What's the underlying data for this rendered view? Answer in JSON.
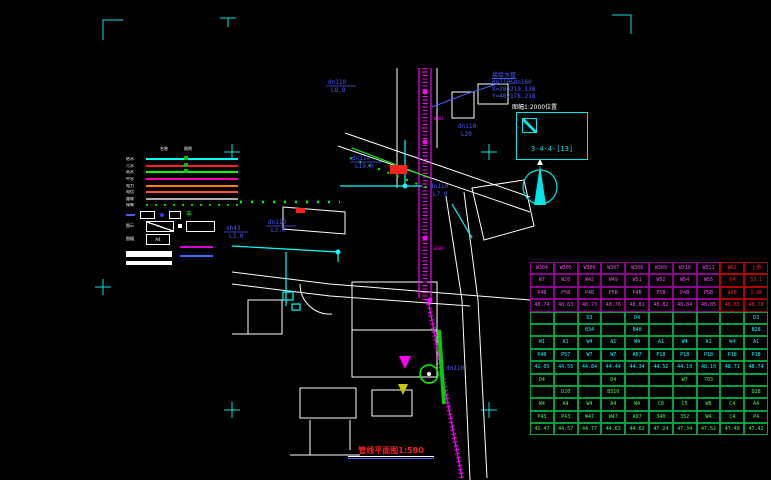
{
  "drawing": {
    "title": "管线平面图1:500",
    "sheet": {
      "above_label": "图幅1:2000位置",
      "code": "3-4-4-[13]"
    },
    "annotation": {
      "line1": "接给水管",
      "line2": "dn110&dn160",
      "line3": "X=286219.138",
      "line4": "Y=482178.218"
    },
    "labels": [
      {
        "t1": "dn110",
        "t2": "L8.0"
      },
      {
        "t1": "dn110",
        "t2": "L19.0"
      },
      {
        "t1": "dn110",
        "t2": "L3.0"
      },
      {
        "t1": "sh43",
        "t2": "L3.0"
      },
      {
        "t1": "dn110",
        "t2": "L20"
      },
      {
        "t1": "dn110",
        "t2": "L7.0"
      },
      {
        "t1": "dn110",
        "t2": ""
      }
    ],
    "pipe_tags": {
      "w1": "W304",
      "w2": "W308"
    },
    "colors": {
      "water": "#00ffff",
      "sewer": "#ff00ff",
      "storm": "#00ff00",
      "label_blue": "#4a5cff",
      "frame_cyan": "#00e5e5",
      "road_white": "#ffffff",
      "title_red": "#ff2020"
    }
  },
  "legend": {
    "col1": "名称",
    "col2": "图例",
    "rows": [
      {
        "label": "给水",
        "color": "#00ffff",
        "style": "solid"
      },
      {
        "label": "污水",
        "color": "#ff2020",
        "style": "solid"
      },
      {
        "label": "雨水",
        "color": "#00ff00",
        "style": "solid"
      },
      {
        "label": "中水",
        "color": "#ff00b0",
        "style": "solid"
      },
      {
        "label": "电力",
        "color": "#ff8000",
        "style": "solid"
      },
      {
        "label": "电信",
        "color": "#ff5030",
        "style": "solid"
      },
      {
        "label": "路缘",
        "color": "#b0b0b0",
        "style": "solid"
      },
      {
        "label": "绿篱",
        "color": "#00d000",
        "style": "dotted"
      }
    ],
    "glyph": "丰",
    "diag_label": "图示",
    "a4_label": "图幅",
    "a4": "A4"
  },
  "table": {
    "top_text": "#ff40ff",
    "top_border": "#90008e",
    "red_text": "#ff2020",
    "red_border": "#b00000",
    "bottom_text_a": "#00ffff",
    "bottom_text_b": "#40ff40",
    "bottom_border": "#00a040",
    "top_rows": [
      [
        "W304",
        "W305",
        "W306",
        "W307",
        "W308",
        "W309",
        "W310",
        "W311",
        "W62",
        "上游"
      ],
      [
        "W7",
        "W20",
        "W42",
        "W49",
        "W51",
        "W52",
        "W54",
        "W55",
        "64",
        "53.1"
      ],
      [
        "P4B",
        "P5B",
        "P4B",
        "P5B",
        "P4B",
        "P5B",
        "P4B",
        "P5B",
        "A88",
        "3.98"
      ],
      [
        "48.74",
        "48.63",
        "48.73",
        "48.76",
        "48.81",
        "48.82",
        "48.84",
        "48.85",
        "48.65",
        "48.78"
      ]
    ],
    "bottom_rows": [
      [
        "",
        "",
        "D3",
        "",
        "D4",
        "",
        "",
        "",
        "",
        "D3"
      ],
      [
        "",
        "",
        "B34",
        "",
        "B48",
        "",
        "",
        "",
        "",
        "B28"
      ],
      [
        "W1",
        "A1",
        "W4",
        "A1",
        "W4",
        "A1",
        "W4",
        "A1",
        "W4",
        "A1"
      ],
      [
        "P48",
        "P57",
        "W7",
        "W7",
        "A07",
        "P18",
        "P18",
        "P18",
        "P18",
        "P18"
      ],
      [
        "41.05",
        "44.55",
        "44.84",
        "44.44",
        "44.34",
        "44.52",
        "44.10",
        "48.10",
        "48.71",
        "48.74"
      ],
      [
        "D4",
        "",
        "",
        "D4",
        "",
        "",
        "W7",
        "703",
        "",
        ""
      ],
      [
        "",
        "D20",
        "",
        "B310",
        "",
        "",
        "",
        "",
        "",
        "D28"
      ],
      [
        "W4",
        "A4",
        "W4",
        "A4",
        "W4",
        "C8",
        "C5",
        "W8",
        "C4",
        "A4"
      ],
      [
        "P43",
        "P43",
        "W47",
        "W47",
        "A07",
        "340",
        "352",
        "W4",
        "C4",
        "P4"
      ],
      [
        "41.47",
        "44.57",
        "44.77",
        "44.63",
        "44.62",
        "47.24",
        "47.34",
        "47.52",
        "47.49",
        "47.42"
      ]
    ]
  }
}
